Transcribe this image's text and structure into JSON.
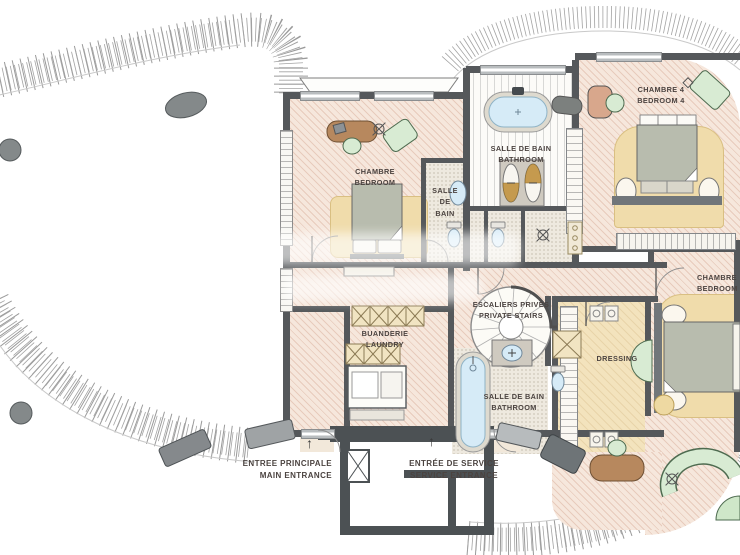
{
  "rooms": {
    "bedroom1": {
      "line1": "CHAMBRE",
      "line2": "BEDROOM"
    },
    "bath_small": {
      "line1": "SALLE",
      "line2": "DE",
      "line3": "BAIN"
    },
    "bath_main": {
      "line1": "SALLE DE BAIN",
      "line2": "BATHROOM"
    },
    "bedroom4": {
      "line1": "CHAMBRE 4",
      "line2": "BEDROOM 4"
    },
    "laundry": {
      "line1": "BUANDERIE",
      "line2": "LAUNDRY"
    },
    "stairs": {
      "line1": "ESCALIERS PRIVÉS",
      "line2": "PRIVATE STAIRS"
    },
    "bath_lower": {
      "line1": "SALLE DE BAIN",
      "line2": "BATHROOM"
    },
    "dressing": {
      "line1": "DRESSING"
    },
    "bedroom_right": {
      "line1": "CHAMBRE",
      "line2": "BEDROOM"
    }
  },
  "entrances": {
    "main": {
      "line1": "ENTREE PRINCIPALE",
      "line2": "MAIN ENTRANCE",
      "arrow": "↑"
    },
    "service": {
      "line1": "ENTRÉE DE SERVICE",
      "line2": "SERVICE ENTRANCE",
      "arrow": "↑"
    }
  },
  "colors": {
    "floor_pink": "#f6e7dc",
    "rug_tan": "#f0dcab",
    "wall_gray": "#55585b",
    "furniture_green": "#d8ebd3",
    "water_blue": "#d6ebf7",
    "wood_brown": "#b7885e",
    "label_text": "#4b4340"
  }
}
